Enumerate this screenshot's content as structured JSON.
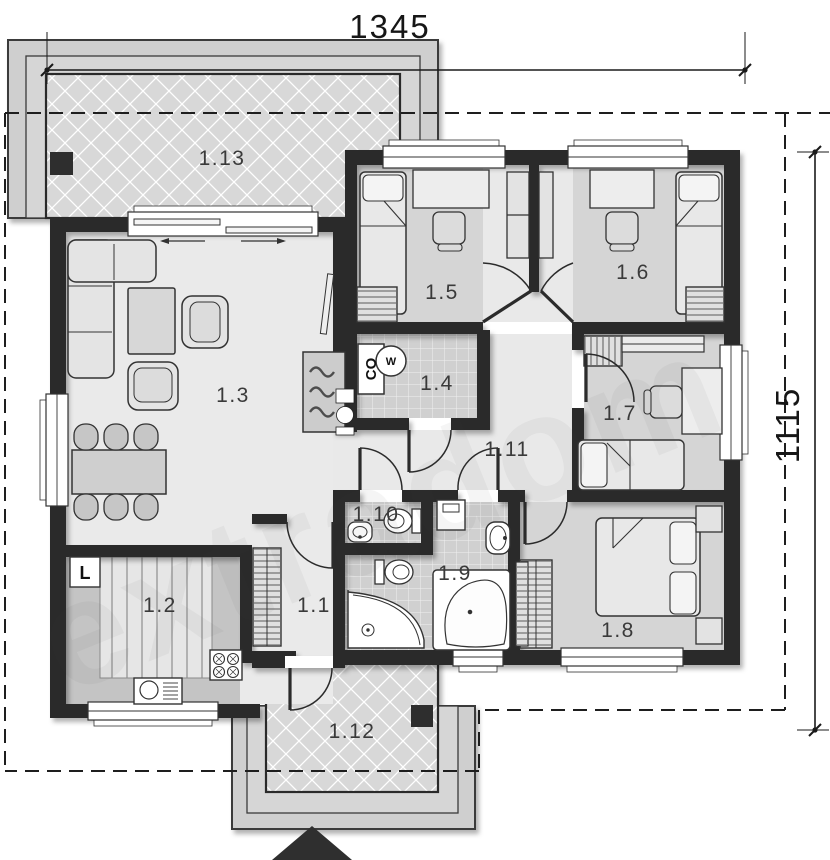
{
  "plan": {
    "watermark": "extradom",
    "dimensions": {
      "top": "1345",
      "right": "1115"
    },
    "rooms": [
      {
        "label": "1.1"
      },
      {
        "label": "1.2"
      },
      {
        "label": "1.3"
      },
      {
        "label": "1.4"
      },
      {
        "label": "1.5"
      },
      {
        "label": "1.6"
      },
      {
        "label": "1.7"
      },
      {
        "label": "1.8"
      },
      {
        "label": "1.9"
      },
      {
        "label": "1.10"
      },
      {
        "label": "1.11"
      },
      {
        "label": "1.12"
      },
      {
        "label": "1.13"
      }
    ],
    "markers": {
      "boiler": "CO",
      "water_heater": "W",
      "fridge": "L"
    },
    "colors": {
      "wall": "#2b2b2b",
      "floor_light": "#eaeaea",
      "floor_bedroom": "#d5d5d5",
      "tile": "#d0d0d0",
      "paving": "#d8d8d8"
    }
  }
}
